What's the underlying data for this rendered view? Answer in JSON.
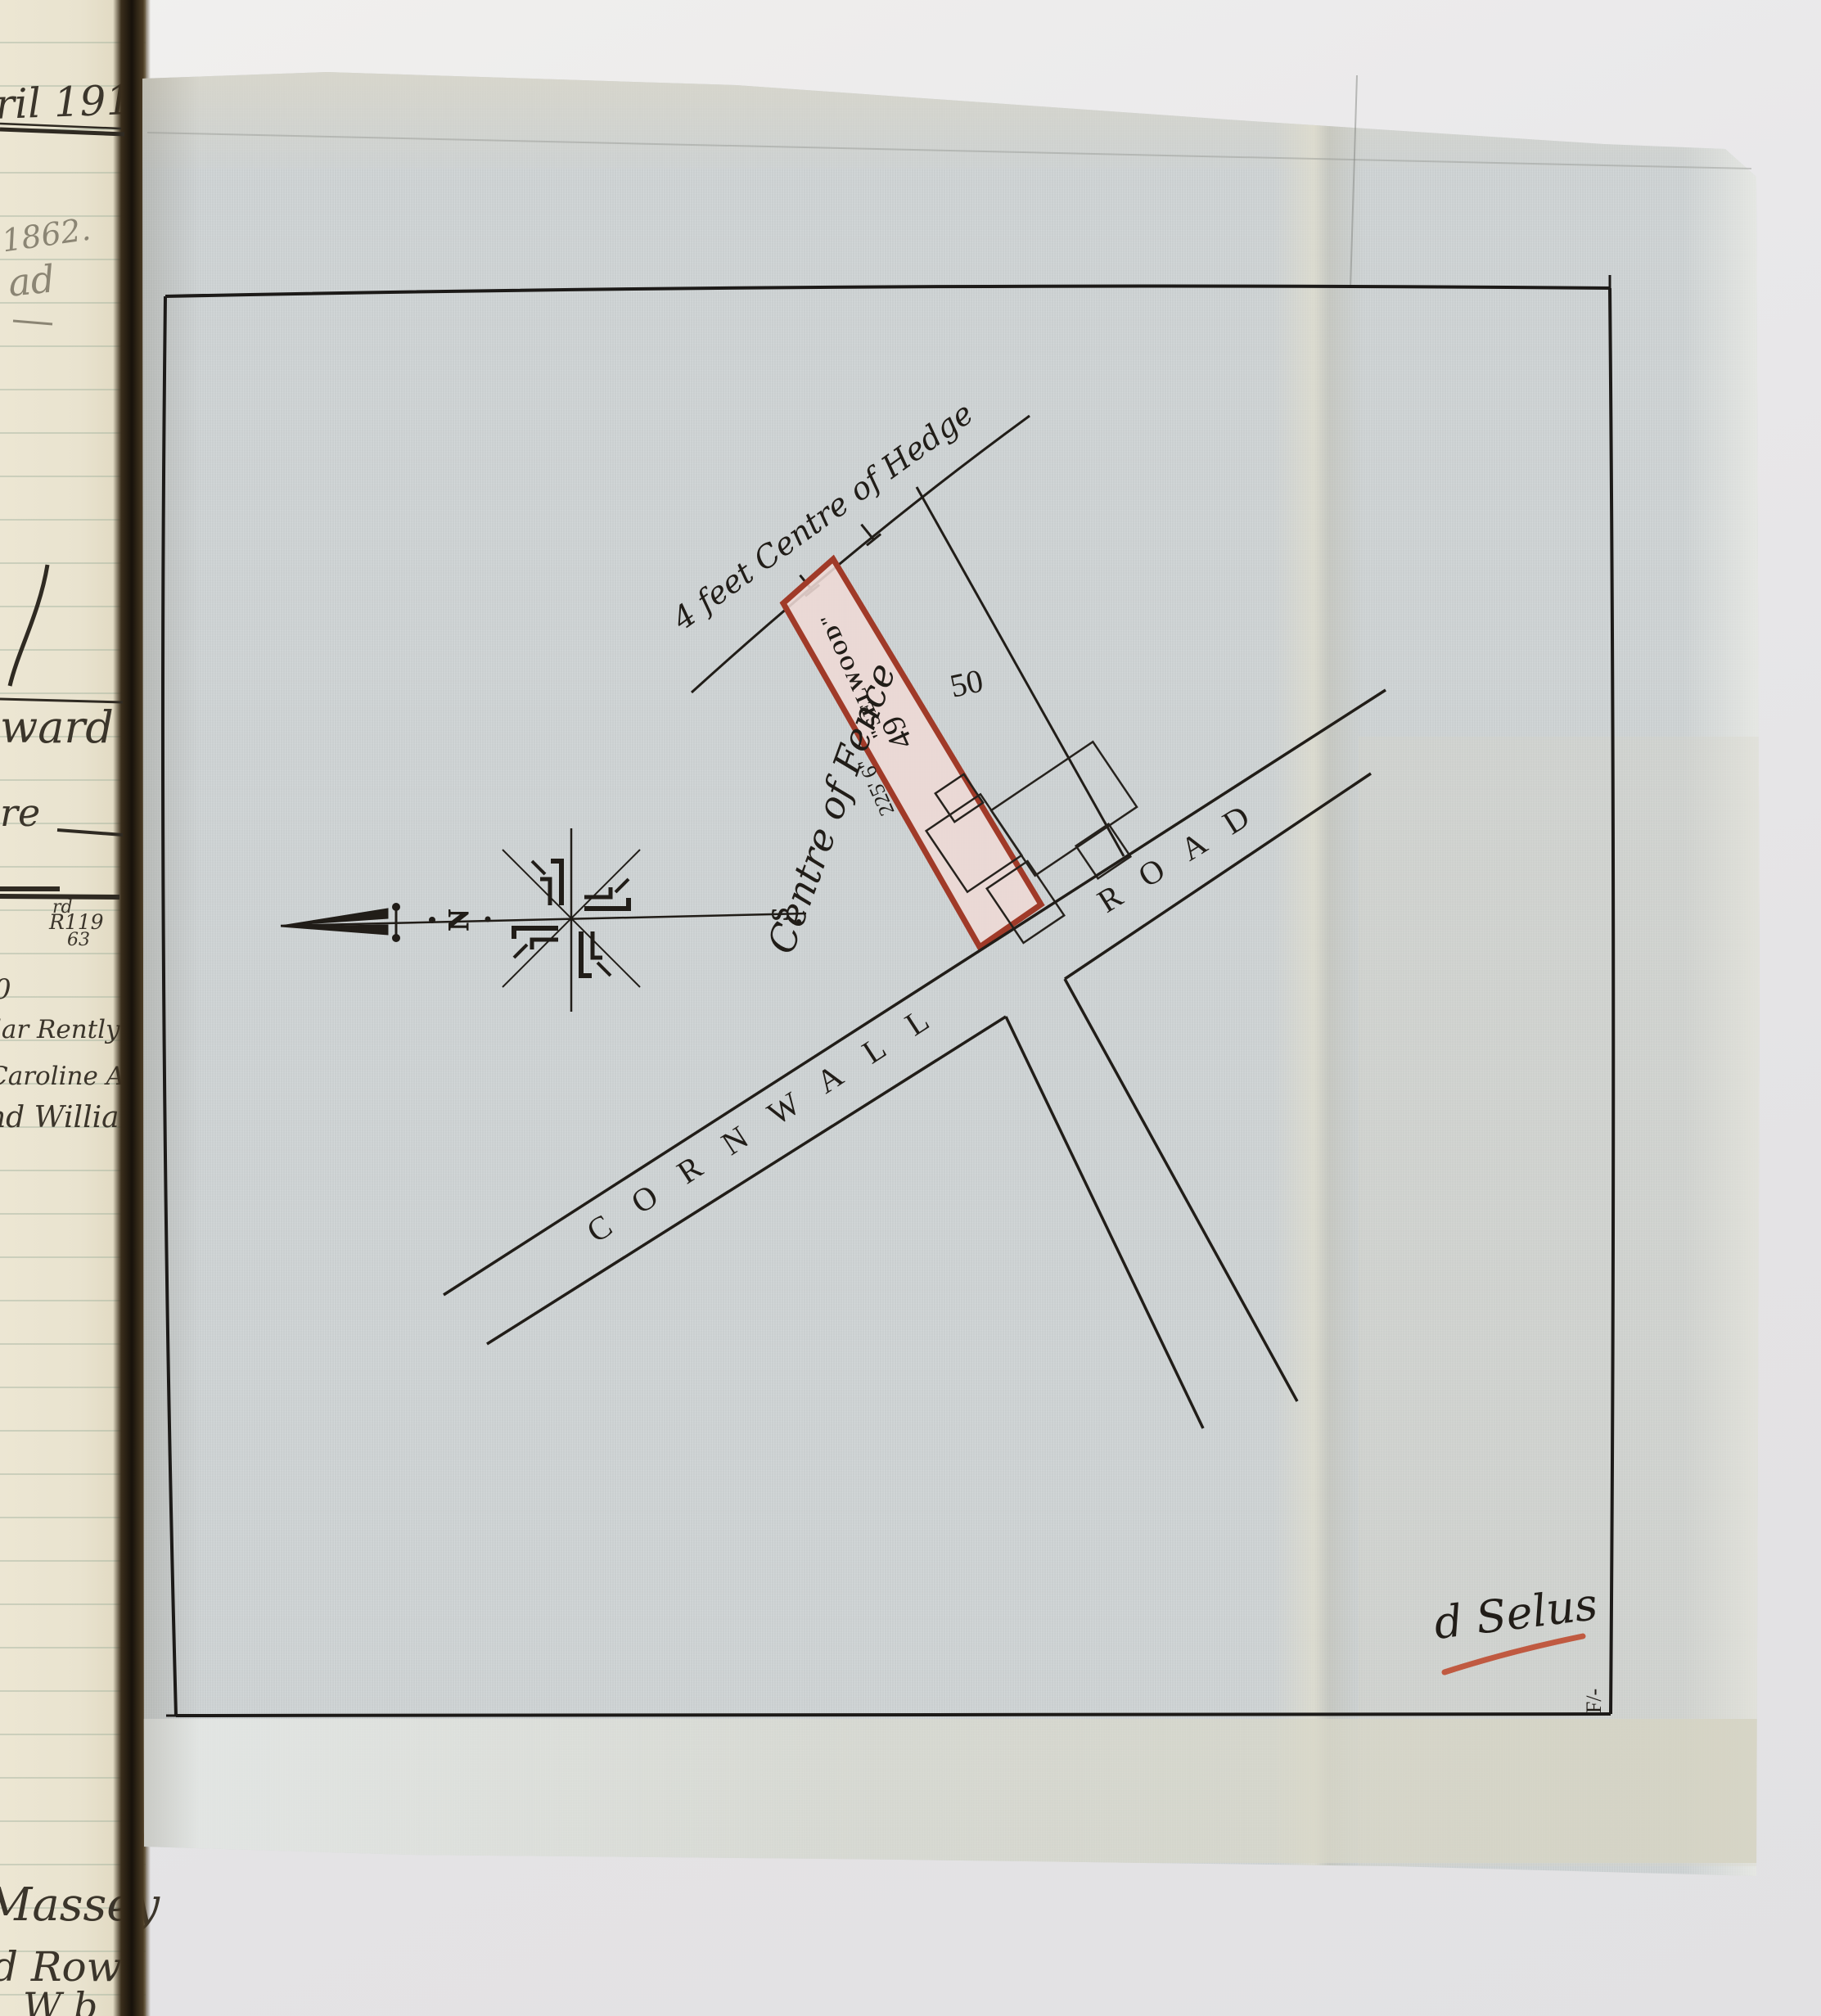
{
  "ledger": {
    "date_fragment": "ril 191",
    "pencil_year": "1862.",
    "pencil_word": "ad",
    "entry_ward": "ward",
    "entry_re": "re",
    "annotation_sup": "rd",
    "annotation_ref": "R119",
    "annotation_num": "63",
    "partial_digit": "0",
    "entry_rently": "ular Rently",
    "entry_caroline": "Caroline Asp",
    "entry_william": "nd William",
    "entry_massey": "Massey",
    "entry_row": "d Row",
    "entry_wb": "W b"
  },
  "plan": {
    "hedge_label": "4 feet Centre of Hedge",
    "fence_label": "Centre of Fence",
    "house_name": "\"SELWOOD\"",
    "plot_number": "49",
    "frontage_dimension": "225' 6\"",
    "adjacent_plot_number": "50",
    "road_name_word1": "CORNWALL",
    "road_name_word2": "ROAD",
    "compass": {
      "north": "N",
      "south": "S"
    },
    "corner_mark": "F/-",
    "signature": "d Selus",
    "colors": {
      "plot_outline": "#a03a28",
      "plot_fill": "#eedad5",
      "signature_ink": "#c05a41",
      "drawing_ink": "#211d18",
      "fabric": "#cdd2d3",
      "ledger_paper": "#eae4d0"
    }
  }
}
